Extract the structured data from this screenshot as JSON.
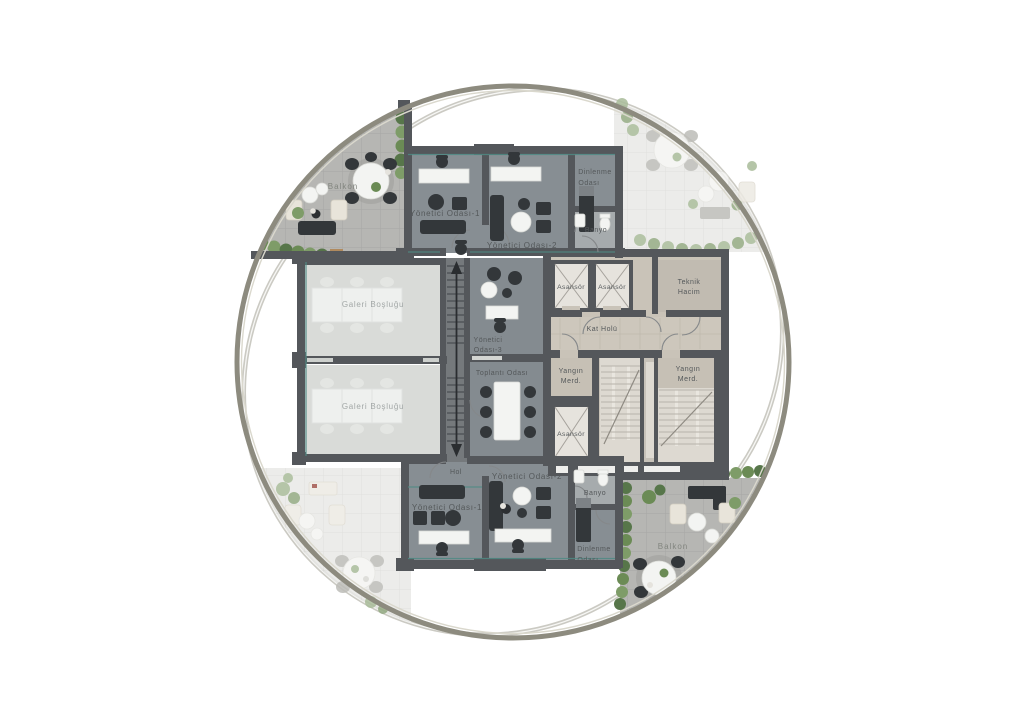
{
  "plan": {
    "kind": "circular office floor plan",
    "labels": {
      "balkon_tl": "Balkon",
      "balkon_br": "Balkon",
      "yo1_top": "Yönetici Odası-1",
      "yo2_top": "Yönetici Odası-2",
      "yo3": {
        "l1": "Yönetici",
        "l2": "Odası-3"
      },
      "toplanti": "Toplantı Odası",
      "galeri1": "Galeri Boşluğu",
      "galeri2": "Galeri Boşluğu",
      "dinlenme_top": {
        "l1": "Dinlenme",
        "l2": "Odası"
      },
      "dinlenme_bottom": {
        "l1": "Dinlenme",
        "l2": "Odası"
      },
      "banyo_top": "Banyo",
      "banyo_bottom": "Banyo",
      "asansor_1": "Asansör",
      "asansor_2": "Asansör",
      "asansor_3": "Asansör",
      "teknik": {
        "l1": "Teknik",
        "l2": "Hacim"
      },
      "kat_holu": "Kat Holü",
      "yangin_left": {
        "l1": "Yangın",
        "l2": "Merd."
      },
      "yangin_right": {
        "l1": "Yangın",
        "l2": "Merd."
      },
      "hol": "Hol",
      "yo1_bottom": "Yönetici Odası-1",
      "yo2_bottom": "Yönetici Odası-2"
    },
    "colors": {
      "wall": "#54575b",
      "office_floor": "#878e93",
      "meeting_floor": "#848b90",
      "core_floor": "#c9c3b8",
      "teknik_floor": "#c1bbb1",
      "stair_floor": "#ddd9d1",
      "gallery_floor": "#d9dbd8",
      "corridor_floor": "#75797c",
      "bath_floor": "#a6abad",
      "balcony_tile": "#b6b6b3",
      "terrace_tile_faded": "#e9e9e7",
      "main_circle": "#8d8b7f",
      "ghost_arc": "#cbcac3",
      "window_teal": "#4f8a84",
      "plant_green": "#6b8b55",
      "furniture_dark": "#33373a",
      "furniture_white": "#f3f4f2",
      "furniture_beige": "#e8e4da",
      "label_text": "#54585a"
    }
  }
}
